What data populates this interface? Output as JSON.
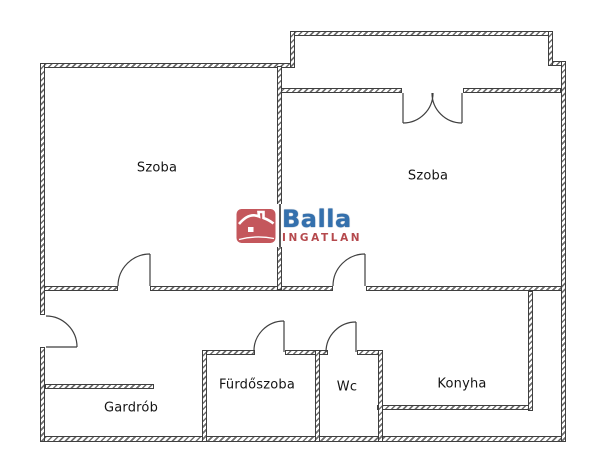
{
  "page": {
    "background": "#ffffff"
  },
  "floorplan": {
    "wall_color": "#3f3f3f",
    "label_color": "#141414",
    "rooms": [
      {
        "id": "szoba-1",
        "label": "Szoba",
        "cx": 157,
        "cy": 168
      },
      {
        "id": "szoba-2",
        "label": "Szoba",
        "cx": 428,
        "cy": 176
      },
      {
        "id": "gardrob",
        "label": "Gardrób",
        "cx": 131,
        "cy": 408
      },
      {
        "id": "furdoszoba",
        "label": "Fürdőszoba",
        "cx": 257,
        "cy": 385
      },
      {
        "id": "wc",
        "label": "Wc",
        "cx": 347,
        "cy": 387
      },
      {
        "id": "konyha",
        "label": "Konyha",
        "cx": 462,
        "cy": 384
      }
    ],
    "walls": [
      [
        40,
        63,
        254,
        5
      ],
      [
        290,
        31,
        263,
        5
      ],
      [
        548,
        61,
        18,
        5
      ],
      [
        278,
        88,
        124,
        5
      ],
      [
        463,
        88,
        98,
        5
      ],
      [
        40,
        286,
        78,
        5
      ],
      [
        150,
        286,
        183,
        5
      ],
      [
        366,
        286,
        200,
        5
      ],
      [
        45,
        384,
        109,
        5
      ],
      [
        202,
        350,
        53,
        5
      ],
      [
        285,
        350,
        43,
        5
      ],
      [
        357,
        350,
        26,
        5
      ],
      [
        377,
        405,
        156,
        5
      ],
      [
        40,
        436,
        526,
        6
      ],
      [
        40,
        63,
        5,
        252
      ],
      [
        40,
        347,
        5,
        95
      ],
      [
        290,
        31,
        5,
        37
      ],
      [
        548,
        31,
        5,
        35
      ],
      [
        561,
        61,
        5,
        381
      ],
      [
        277,
        66,
        5,
        224
      ],
      [
        202,
        350,
        5,
        92
      ],
      [
        315,
        350,
        5,
        92
      ],
      [
        378,
        350,
        5,
        92
      ],
      [
        528,
        291,
        5,
        120
      ]
    ],
    "doors": [
      {
        "id": "entry-door",
        "leaf": [
          46,
          347,
          77,
          347
        ],
        "arc": [
          77,
          347,
          31,
          46,
          316,
          0
        ]
      },
      {
        "id": "szoba1-door",
        "leaf": [
          150,
          286,
          150,
          254
        ],
        "arc": [
          150,
          254,
          32,
          118,
          286,
          0
        ]
      },
      {
        "id": "szoba2-door",
        "leaf": [
          365,
          286,
          365,
          254
        ],
        "arc": [
          365,
          254,
          32,
          333,
          286,
          0
        ]
      },
      {
        "id": "balcony-door-left",
        "leaf": [
          403,
          93,
          403,
          123
        ],
        "arc": [
          403,
          123,
          30,
          433,
          93,
          0
        ]
      },
      {
        "id": "balcony-door-right",
        "leaf": [
          462,
          93,
          462,
          123
        ],
        "arc": [
          462,
          123,
          30,
          432,
          93,
          1
        ]
      },
      {
        "id": "furdoszoba-door",
        "leaf": [
          284,
          352,
          284,
          321
        ],
        "arc": [
          284,
          321,
          30,
          254,
          352,
          0
        ]
      },
      {
        "id": "wc-door",
        "leaf": [
          356,
          352,
          356,
          322
        ],
        "arc": [
          356,
          322,
          30,
          326,
          352,
          0
        ]
      }
    ]
  },
  "logo": {
    "brand": "Balla",
    "subtitle": "INGATLAN",
    "brand_color": "#3470ad",
    "subtitle_color": "#b5494d",
    "house_color": "#c4575c"
  }
}
